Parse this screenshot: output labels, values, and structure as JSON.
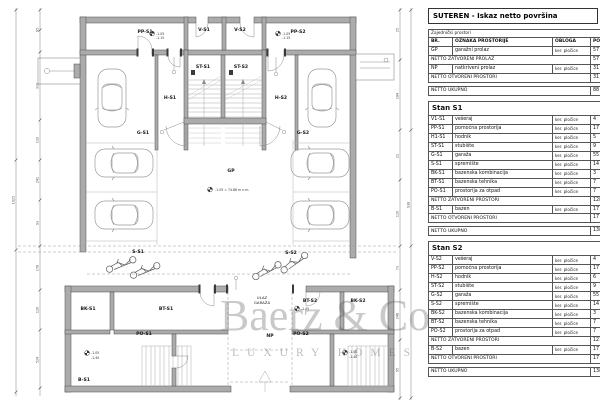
{
  "watermark": {
    "line1": "Baerz & Co",
    "line2": "LUXURY HOMES"
  },
  "table_panel": {
    "title": "SUTEREN - Iskaz netto površina",
    "sections": [
      {
        "kind": "common",
        "subtitle": "Zajednički prostori",
        "columns": [
          "BR.",
          "OZNAKA PROSTORIJE",
          "OBLOGA",
          "POVRŠINA"
        ],
        "rows": [
          {
            "t": "item",
            "br": "GP",
            "name": "garažni prolaz",
            "obloga": "ker. pločice",
            "pov": "57"
          },
          {
            "t": "total",
            "label": "NETTO ZATVORENI PROLAZ",
            "pov": "57"
          },
          {
            "t": "item",
            "br": "NP",
            "name": "natkriveni prolaz",
            "obloga": "ker. pločice",
            "pov": "31"
          },
          {
            "t": "total",
            "label": "NETTO OTVORENI PROSTORI",
            "pov": "31"
          },
          {
            "t": "grand",
            "label": "NETTO UKUPNO",
            "pov": "88"
          }
        ]
      },
      {
        "kind": "stan",
        "title": "Stan S1",
        "rows": [
          {
            "t": "item",
            "br": "V1-S1",
            "name": "vešeraj",
            "obloga": "ker. pločice",
            "pov": "4"
          },
          {
            "t": "item",
            "br": "PP-S1",
            "name": "pomoćna prostorija",
            "obloga": "ker. pločice",
            "pov": "17"
          },
          {
            "t": "item",
            "br": "H1-S1",
            "name": "hodnik",
            "obloga": "ker. pločice",
            "pov": "5"
          },
          {
            "t": "item",
            "br": "ST-S1",
            "name": "stubište",
            "obloga": "ker. pločice",
            "pov": "9"
          },
          {
            "t": "item",
            "br": "G-S1",
            "name": "garaža",
            "obloga": "ker. pločice",
            "pov": "55"
          },
          {
            "t": "item",
            "br": "S-S1",
            "name": "spremište",
            "obloga": "ker. pločice",
            "pov": "14"
          },
          {
            "t": "item",
            "br": "BK-S1",
            "name": "bazenska kombinacija",
            "obloga": "ker. pločice",
            "pov": "3"
          },
          {
            "t": "item",
            "br": "BT-S1",
            "name": "bazenska tehnika",
            "obloga": "ker. pločice",
            "pov": "7"
          },
          {
            "t": "item",
            "br": "PO-S1",
            "name": "prostorija za otpad",
            "obloga": "ker. pločice",
            "pov": "7"
          },
          {
            "t": "total",
            "label": "NETTO ZATVORENI PROSTORI",
            "pov": "128"
          },
          {
            "t": "item",
            "br": "B-S1",
            "name": "bazen",
            "obloga": "ker. pločice",
            "pov": "17"
          },
          {
            "t": "total",
            "label": "NETTO OTVORENI PROSTORI",
            "pov": "17"
          },
          {
            "t": "grand",
            "label": "NETTO UKUPNO",
            "pov": "138"
          }
        ]
      },
      {
        "kind": "stan",
        "title": "Stan S2",
        "rows": [
          {
            "t": "item",
            "br": "V-S2",
            "name": "vešeraj",
            "obloga": "ker. pločice",
            "pov": "4"
          },
          {
            "t": "item",
            "br": "PP-S2",
            "name": "pomoćna prostorija",
            "obloga": "ker. pločice",
            "pov": "17"
          },
          {
            "t": "item",
            "br": "H-S2",
            "name": "hodnik",
            "obloga": "ker. pločice",
            "pov": "6"
          },
          {
            "t": "item",
            "br": "ST-S2",
            "name": "stubište",
            "obloga": "ker. pločice",
            "pov": "9"
          },
          {
            "t": "item",
            "br": "G-S2",
            "name": "garaža",
            "obloga": "ker. pločice",
            "pov": "55"
          },
          {
            "t": "item",
            "br": "S-S2",
            "name": "spremište",
            "obloga": "ker. pločice",
            "pov": "14"
          },
          {
            "t": "item",
            "br": "BK-S2",
            "name": "bazenska kombinacija",
            "obloga": "ker. pločice",
            "pov": "3"
          },
          {
            "t": "item",
            "br": "BT-S2",
            "name": "bazenska tehnika",
            "obloga": "ker. pločice",
            "pov": "7"
          },
          {
            "t": "item",
            "br": "PO-S2",
            "name": "prostorija za otpad",
            "obloga": "ker. pločice",
            "pov": "7"
          },
          {
            "t": "total",
            "label": "NETTO ZATVORENI PROSTORI",
            "pov": "121"
          },
          {
            "t": "item",
            "br": "B-S2",
            "name": "bazen",
            "obloga": "ker. pločice",
            "pov": "17"
          },
          {
            "t": "total",
            "label": "NETTO OTVORENI PROSTORI",
            "pov": "17"
          },
          {
            "t": "grand",
            "label": "NETTO UKUPNO",
            "pov": "138"
          }
        ]
      }
    ]
  },
  "plan": {
    "labels": [
      {
        "id": "pp-s1",
        "text": "PP-S1",
        "x": 145,
        "y": 33
      },
      {
        "id": "v-s1",
        "text": "V-S1",
        "x": 204,
        "y": 31
      },
      {
        "id": "v-s2",
        "text": "V-S2",
        "x": 240,
        "y": 31
      },
      {
        "id": "pp-s2",
        "text": "PP-S2",
        "x": 298,
        "y": 33
      },
      {
        "id": "st-s1",
        "text": "ST-S1",
        "x": 203,
        "y": 68
      },
      {
        "id": "st-s2",
        "text": "ST-S2",
        "x": 241,
        "y": 68
      },
      {
        "id": "h-s1",
        "text": "H-S1",
        "x": 170,
        "y": 99
      },
      {
        "id": "h-s2",
        "text": "H-S2",
        "x": 281,
        "y": 99
      },
      {
        "id": "g-s1",
        "text": "G-S1",
        "x": 143,
        "y": 134
      },
      {
        "id": "g-s2",
        "text": "G-S2",
        "x": 303,
        "y": 134
      },
      {
        "id": "gp",
        "text": "GP",
        "x": 231,
        "y": 172
      },
      {
        "id": "s-s1",
        "text": "S-S1",
        "x": 138,
        "y": 253
      },
      {
        "id": "s-s2",
        "text": "S-S2",
        "x": 291,
        "y": 254
      },
      {
        "id": "bk-s1",
        "text": "BK-S1",
        "x": 88,
        "y": 310
      },
      {
        "id": "bt-s1",
        "text": "BT-S1",
        "x": 166,
        "y": 310
      },
      {
        "id": "ulaz-line1",
        "text": "ULAZ",
        "x": 262,
        "y": 299,
        "cls": "sm"
      },
      {
        "id": "ulaz-line2",
        "text": "GARAŽA",
        "x": 262,
        "y": 304,
        "cls": "sm"
      },
      {
        "id": "bt-s2",
        "text": "BT-S2",
        "x": 310,
        "y": 302
      },
      {
        "id": "bk-s2",
        "text": "BK-S2",
        "x": 358,
        "y": 302
      },
      {
        "id": "po-s1",
        "text": "PO-S1",
        "x": 144,
        "y": 335
      },
      {
        "id": "np",
        "text": "NP",
        "x": 270,
        "y": 337
      },
      {
        "id": "po-s2",
        "text": "PO-S2",
        "x": 301,
        "y": 335
      },
      {
        "id": "b-s1",
        "text": "B-S1",
        "x": 84,
        "y": 381
      }
    ],
    "annotations": [
      {
        "t": "-1.05",
        "x": 156,
        "y": 35
      },
      {
        "t": "-1.15",
        "x": 156,
        "y": 39
      },
      {
        "t": "-1.05",
        "x": 282,
        "y": 35
      },
      {
        "t": "-1.15",
        "x": 282,
        "y": 39
      },
      {
        "t": "-1.05 = 74.86 m n.m.",
        "x": 215,
        "y": 191
      },
      {
        "t": "-1.05",
        "x": 91,
        "y": 354
      },
      {
        "t": "-1.40",
        "x": 91,
        "y": 359
      },
      {
        "t": "-1.05",
        "x": 349,
        "y": 353
      },
      {
        "t": "-1.40",
        "x": 349,
        "y": 358
      },
      {
        "t": "-1.05",
        "x": 301,
        "y": 310
      }
    ],
    "dims": [
      {
        "t": "95",
        "x": 38.5,
        "y": 30
      },
      {
        "t": "310",
        "x": 38.5,
        "y": 86
      },
      {
        "t": "110",
        "x": 38.5,
        "y": 140
      },
      {
        "t": "241",
        "x": 38.5,
        "y": 180
      },
      {
        "t": "93",
        "x": 38.5,
        "y": 223
      },
      {
        "t": "178",
        "x": 38.5,
        "y": 268
      },
      {
        "t": "120",
        "x": 38.5,
        "y": 310
      },
      {
        "t": "524",
        "x": 38.5,
        "y": 360
      },
      {
        "t": "1025",
        "x": 14.5,
        "y": 200
      },
      {
        "t": "25",
        "x": 398.5,
        "y": 30
      },
      {
        "t": "184",
        "x": 398.5,
        "y": 96
      },
      {
        "t": "21",
        "x": 398.5,
        "y": 156
      },
      {
        "t": "110",
        "x": 398.5,
        "y": 214
      },
      {
        "t": "73",
        "x": 398.5,
        "y": 268
      },
      {
        "t": "248",
        "x": 398.5,
        "y": 316
      },
      {
        "t": "95",
        "x": 398.5,
        "y": 370
      },
      {
        "t": "938",
        "x": 409.5,
        "y": 205
      }
    ]
  }
}
